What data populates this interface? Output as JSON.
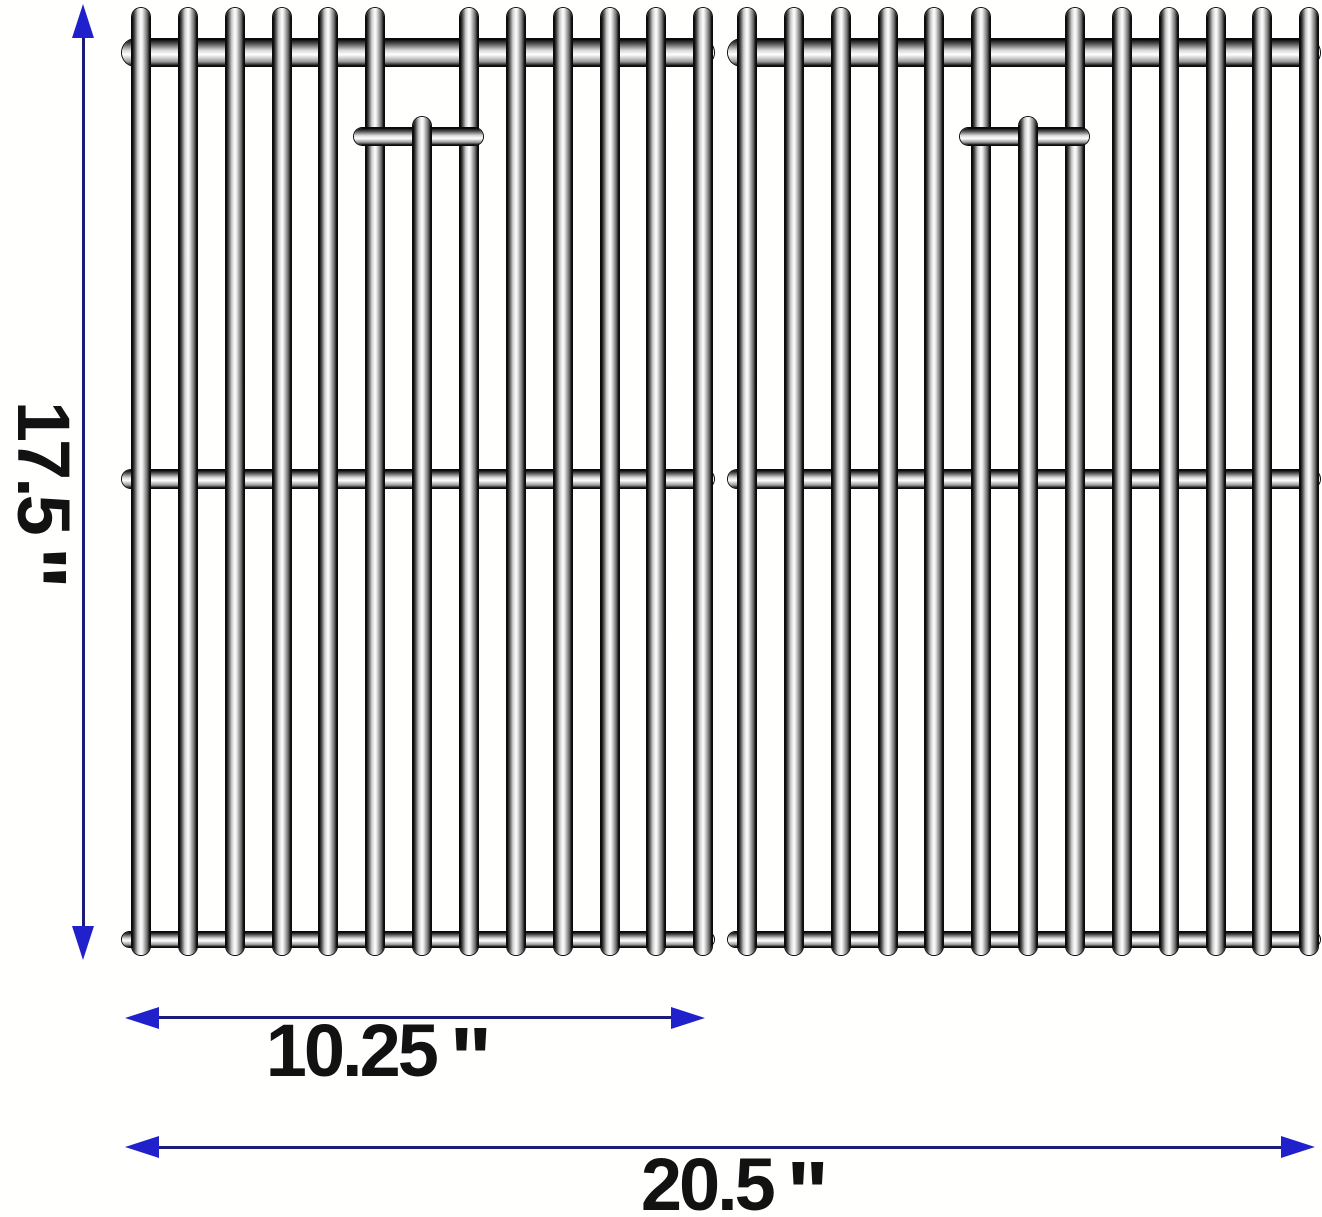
{
  "diagram": {
    "description": "two stainless steel grill cooking grates with dimension arrows",
    "colors": {
      "arrow_line": "#1b1b78",
      "arrow_head": "#2121cc",
      "label_text": "#121212"
    },
    "dimensions": {
      "height": {
        "value": "17.5",
        "unit": "\""
      },
      "grate_width": {
        "value": "10.25",
        "unit": "\""
      },
      "total_width": {
        "value": "20.5",
        "unit": "\""
      }
    },
    "grates": {
      "count": 2,
      "bars_per_grate": 13,
      "hook_bar_index": 7
    }
  }
}
